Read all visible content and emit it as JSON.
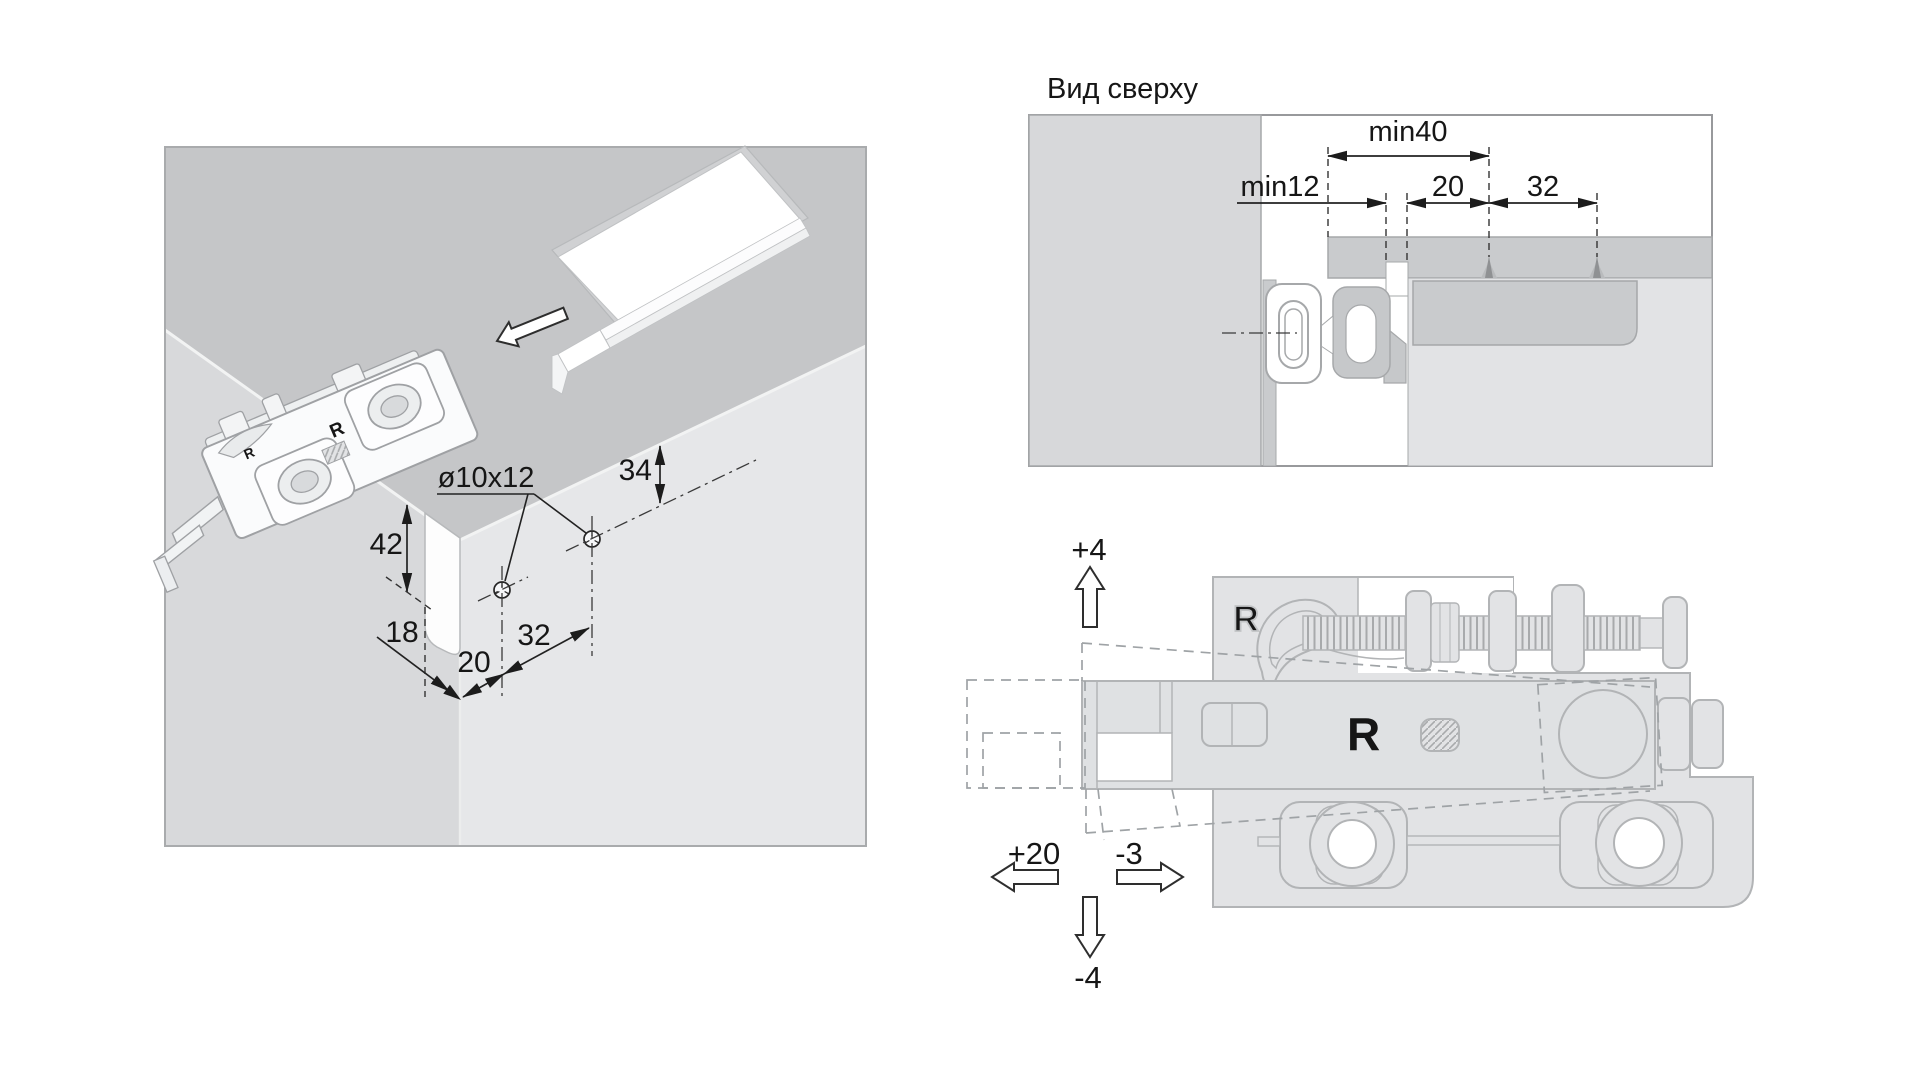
{
  "page": {
    "background": "#ffffff"
  },
  "iso_view": {
    "dim_42": "42",
    "dim_18": "18",
    "dim_20": "20",
    "dim_32": "32",
    "dim_34": "34",
    "hole_label": "ø10x12",
    "brand_letter": "R"
  },
  "top_view": {
    "title": "Вид сверху",
    "dim_min40": "min40",
    "dim_min12": "min12",
    "dim_20": "20",
    "dim_32": "32"
  },
  "side_view": {
    "adjust_up": "+4",
    "adjust_down": "-4",
    "adjust_left": "+20",
    "adjust_right": "-3",
    "brand_letter": "R"
  },
  "colors": {
    "cabinet_top": "#c5c6c8",
    "wall_left": "#d8d9db",
    "wall_right": "#e6e7e9",
    "panel_gray": "#d7d8da",
    "bar_gray": "#c9cbcd",
    "hardware_gray": "#e2e3e5",
    "hardware_stroke": "#b2b4b6",
    "dimension_black": "#1c1c1c"
  }
}
